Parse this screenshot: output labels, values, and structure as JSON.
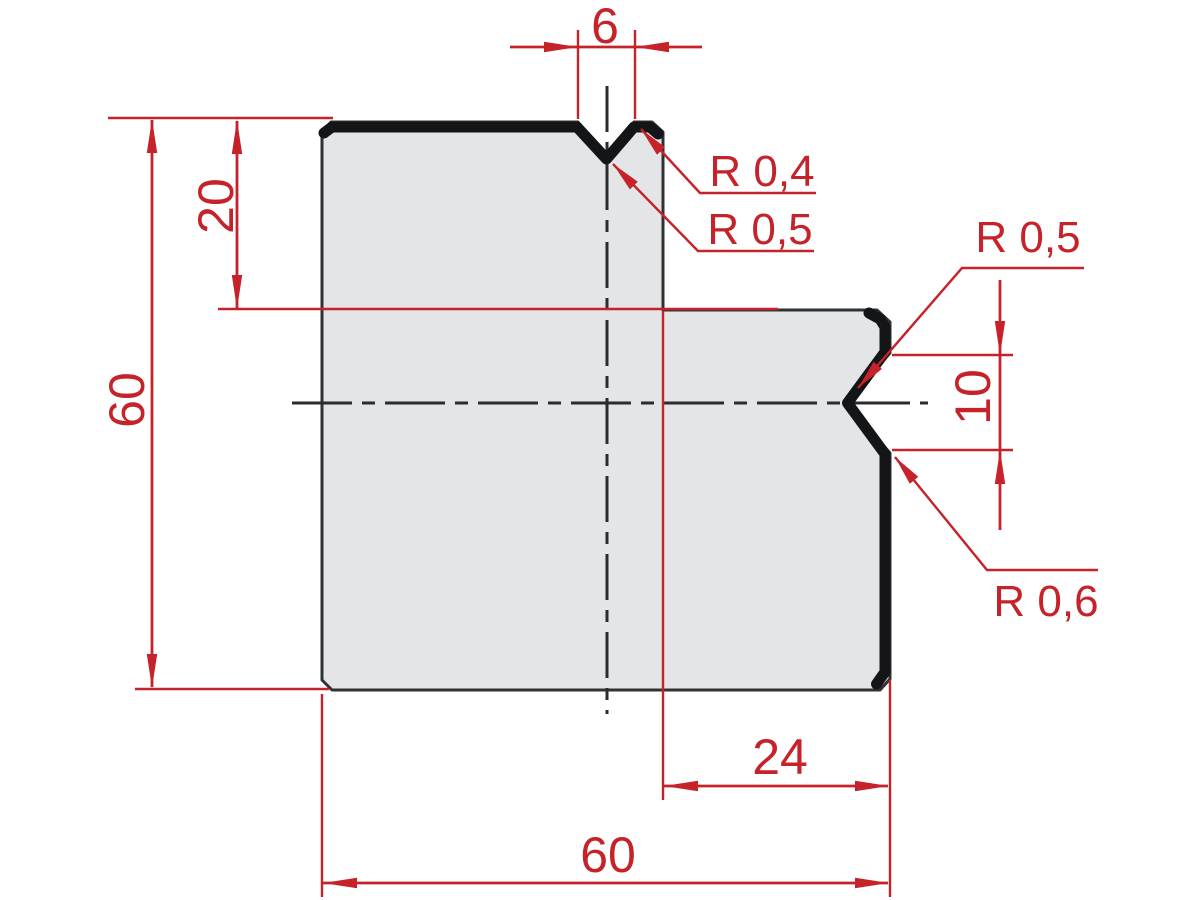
{
  "drawing": {
    "kind": "press-brake die cross-section, dimensioned technical drawing",
    "labels": {
      "top_width": "6",
      "left_offset": "20",
      "left_height": "60",
      "radius_top_flank": "R 0,4",
      "radius_top_groove": "R 0,5",
      "radius_right_upper": "R 0,5",
      "right_notch_height": "10",
      "radius_right_lower": "R 0,6",
      "bottom_offset": "24",
      "bottom_width": "60"
    },
    "colors": {
      "dimension_red": "#c5222a",
      "body_fill": "#e3e5e7",
      "body_outline": "#303234",
      "working_edge_black": "#141517",
      "background": "#ffffff"
    }
  }
}
